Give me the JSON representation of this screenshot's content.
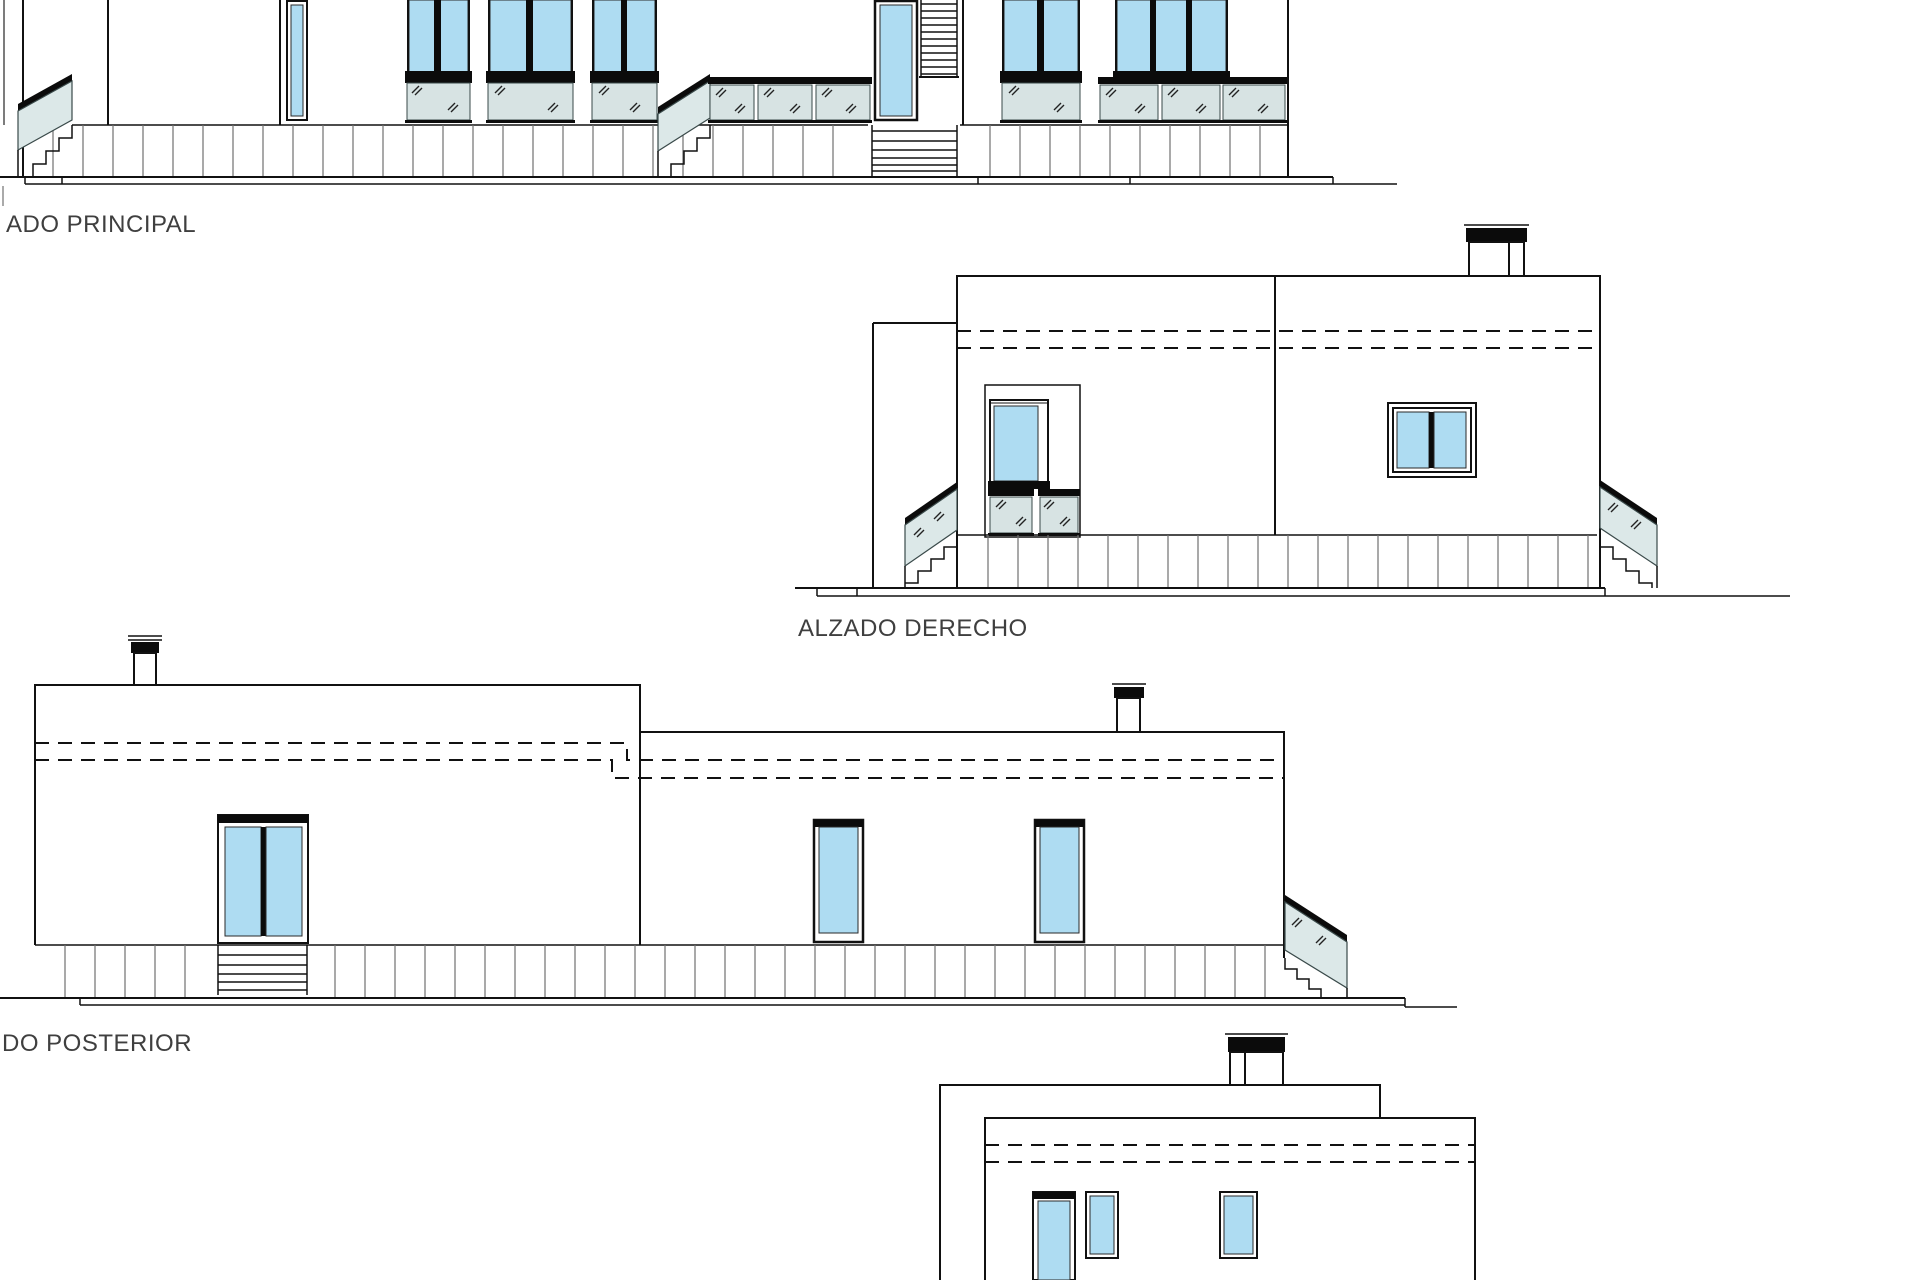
{
  "sheet": {
    "kind": "architectural-elevations-drawing",
    "background": "#ffffff"
  },
  "colors": {
    "paper": "#ffffff",
    "line": "#111111",
    "glass_blue": "#aedcf2",
    "railing_glass": "#dce8e8",
    "balustrade_glass": "#d7e3e3",
    "plinth_line": "#707070",
    "label_text": "#3f3f3f"
  },
  "elevations": [
    {
      "name": "alzado-principal",
      "label": "ADO PRINCIPAL"
    },
    {
      "name": "alzado-derecho",
      "label": "ALZADO DERECHO"
    },
    {
      "name": "alzado-posterior",
      "label": "DO POSTERIOR"
    },
    {
      "name": "alzado-partial-bottom",
      "label": ""
    }
  ]
}
